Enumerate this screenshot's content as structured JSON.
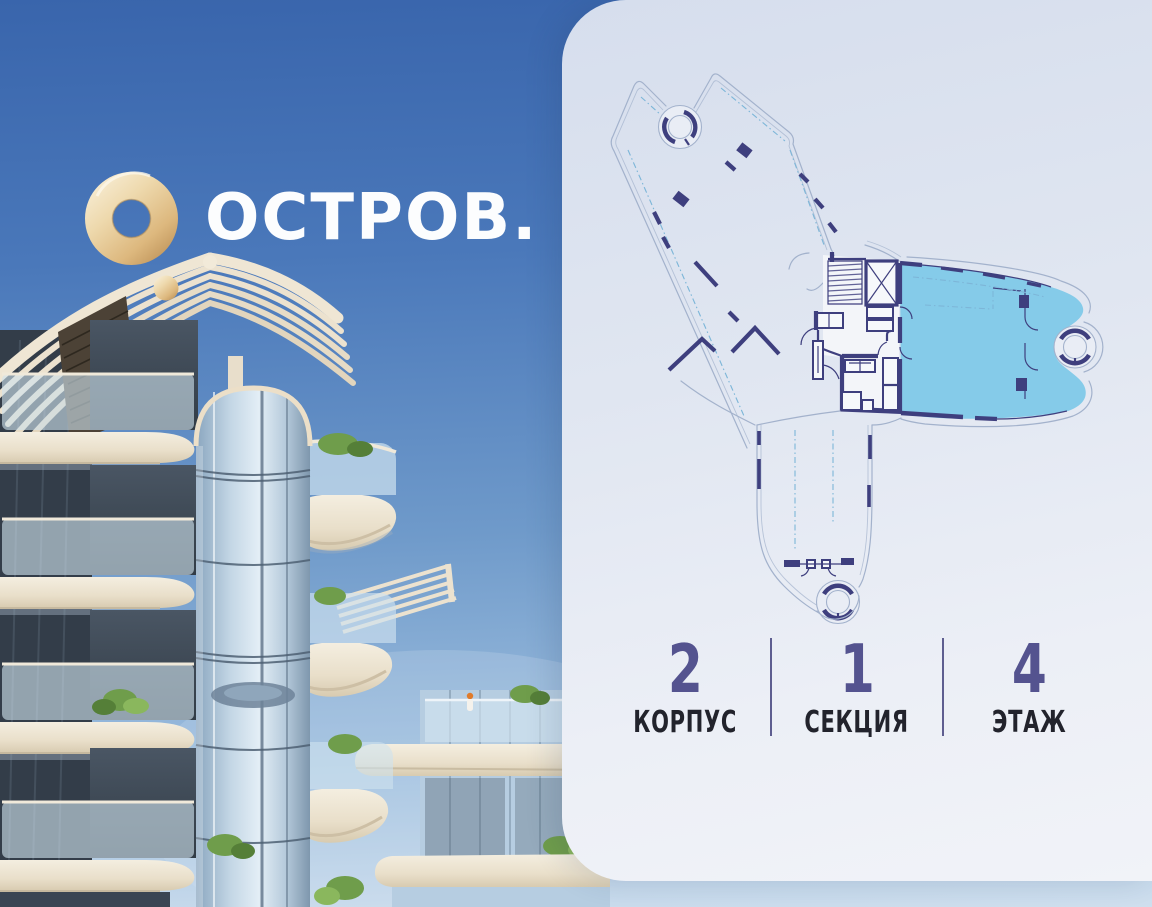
{
  "brand": {
    "wordmark": "ОСТРОВ."
  },
  "floor_plan": {
    "description": "building footprint with highlighted apartment",
    "highlighted_apartment_color": "#85cbe9"
  },
  "stats": {
    "items": [
      {
        "value": "2",
        "label": "КОРПУС"
      },
      {
        "value": "1",
        "label": "СЕКЦИЯ"
      },
      {
        "value": "4",
        "label": "ЭТАЖ"
      }
    ]
  },
  "colors": {
    "stat_value": "#54538f",
    "stat_label": "#22232c",
    "stat_divider": "#45447e",
    "plan_highlight": "#85cbe9",
    "plan_wall": "#3e3f7e",
    "plan_outline": "#a3b2cc",
    "logo_gold": "#ddb87e"
  }
}
